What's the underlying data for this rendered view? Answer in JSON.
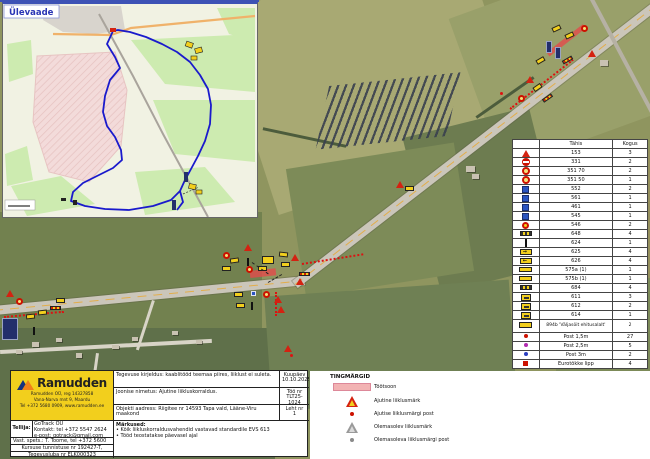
{
  "inset": {
    "label": "Ülevaade"
  },
  "legend_table": {
    "col_code": "Tähis",
    "col_count": "Kogus",
    "rows": [
      {
        "icon": "warning-triangle-sign",
        "code": "153",
        "count": "3"
      },
      {
        "icon": "no-entry-sign",
        "code": "331",
        "count": "2"
      },
      {
        "icon": "speed-limit-sign",
        "code": "351 70",
        "count": "2"
      },
      {
        "icon": "speed-limit-sign",
        "code": "351 50",
        "count": "1"
      },
      {
        "icon": "blue-info-sign",
        "code": "552",
        "count": "2"
      },
      {
        "icon": "blue-info-sign",
        "code": "561",
        "count": "1"
      },
      {
        "icon": "blue-info-sign",
        "code": "461",
        "count": "1"
      },
      {
        "icon": "blue-info-sign",
        "code": "545",
        "count": "1"
      },
      {
        "icon": "yellow-red-sign",
        "code": "546",
        "count": "2"
      },
      {
        "icon": "barrier-board-sign",
        "code": "648",
        "count": "4"
      },
      {
        "icon": "post-marker-sign",
        "code": "624",
        "count": "1"
      },
      {
        "icon": "arrow-right-sign",
        "code": "625",
        "count": "4"
      },
      {
        "icon": "arrow-left-sign",
        "code": "626",
        "count": "4"
      },
      {
        "icon": "yellow-board-sign",
        "code": "575a (1)",
        "count": "1"
      },
      {
        "icon": "yellow-board-sign",
        "code": "575b (1)",
        "count": "1"
      },
      {
        "icon": "barrier-board-sign",
        "code": "684",
        "count": "4"
      },
      {
        "icon": "detour-board-sign",
        "code": "611",
        "count": "3"
      },
      {
        "icon": "detour-board-sign",
        "code": "612",
        "count": "2"
      },
      {
        "icon": "detour-board-sign",
        "code": "614",
        "count": "1"
      },
      {
        "icon": "custom-text-sign",
        "code": "894b 'Väljasõit ehitusalalt'",
        "count": "2"
      },
      {
        "icon": "post-dot-red",
        "code": "Post 1,5m",
        "count": "27"
      },
      {
        "icon": "post-dot-magenta",
        "code": "Post 2,5m",
        "count": "5"
      },
      {
        "icon": "post-dot-blue",
        "code": "Post 3m",
        "count": "2"
      },
      {
        "icon": "flag-red",
        "code": "Eurotõkke lipp",
        "count": "4"
      }
    ]
  },
  "tingmargid": {
    "title": "TINGMÄRGID",
    "items": [
      {
        "icon": "work-zone-swatch",
        "label": "Töötsoon"
      },
      {
        "icon": "temporary-sign-triangle",
        "label": "Ajutine liiklusmärk"
      },
      {
        "icon": "temporary-post-dot",
        "label": "Ajutise liiklusmärgi post"
      },
      {
        "icon": "existing-sign-triangle",
        "label": "Olemasolev liiklusmärk"
      },
      {
        "icon": "existing-post-dot",
        "label": "Olemasoleva liiklusmärgi post"
      }
    ]
  },
  "info": {
    "brand": "Ramudden",
    "brand_line1": "Ramudden OÜ, reg 14327858",
    "brand_line2": "Vana-Narva mnt 9, Maardu",
    "brand_line3": "Tel +372 5680 0909, www.ramudden.ee",
    "client_label": "Tellija:",
    "client_line1": "GoTrack OÜ",
    "client_line2": "Kontakt: tel +372 5547 2624",
    "client_line3": "e-post: gotrack@gmail.com",
    "resp_line": "Vast. spets.: T. Toome, tel +372 5600 5021",
    "cert_line": "Kursuse tunnistuse nr 192427-T, Tallinn",
    "license_line": "Tegevusluba nr ELK000323",
    "desc_line": "Tegevuse kirjeldus: kaablitööd teemaa piires, liiklust ei suleta.",
    "drawing_line": "Joonise nimetus: Ajutine liikluskorraldus.",
    "address_line": "Objekti aadress: Riigitee nr 14593 Tapa vald, Lääne-Viru maakond",
    "notes_title": "Märkused:",
    "note1": "• Kõik liikluskorraldusvahendid vastavad standardile EVS 613",
    "note2": "• Tööd teostatakse päevasel ajal",
    "date_label": "Kuupäev",
    "date_value": "10.10.2025",
    "job_label": "Töö nr",
    "job_value": "TLT25-1024",
    "sheet_label": "Leht nr",
    "sheet_value": "1",
    "colors": {
      "brand_yellow": "#f2cf1d",
      "work_zone_pink": "#f2b3b3",
      "sign_red": "#cc1100",
      "route_blue": "#1a1acc"
    }
  }
}
